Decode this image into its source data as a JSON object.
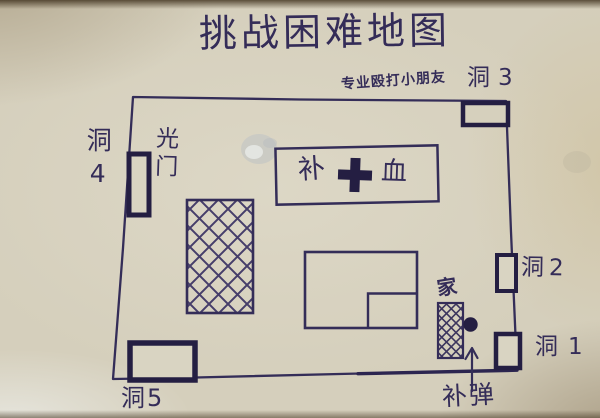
{
  "title": "挑战困难地图",
  "subtitle": "专业殴打小朋友",
  "labels": {
    "hole_1": "洞1",
    "hole_2": "洞2",
    "hole_3": "洞3",
    "hole_4": "洞4",
    "hole_5": "洞5",
    "light_door": "光门",
    "home": "家",
    "ammo_refill": "补弹",
    "health_refill_left": "补",
    "health_refill_right": "血"
  },
  "symbols": {
    "health_cross": "plus-cross-icon",
    "ammo_arrow": "up-arrow-icon",
    "spawn_dot": "filled-dot"
  },
  "colors": {
    "paper": "#d5cfbc",
    "ink": "#3a3163",
    "ink_bold": "#241e42"
  }
}
